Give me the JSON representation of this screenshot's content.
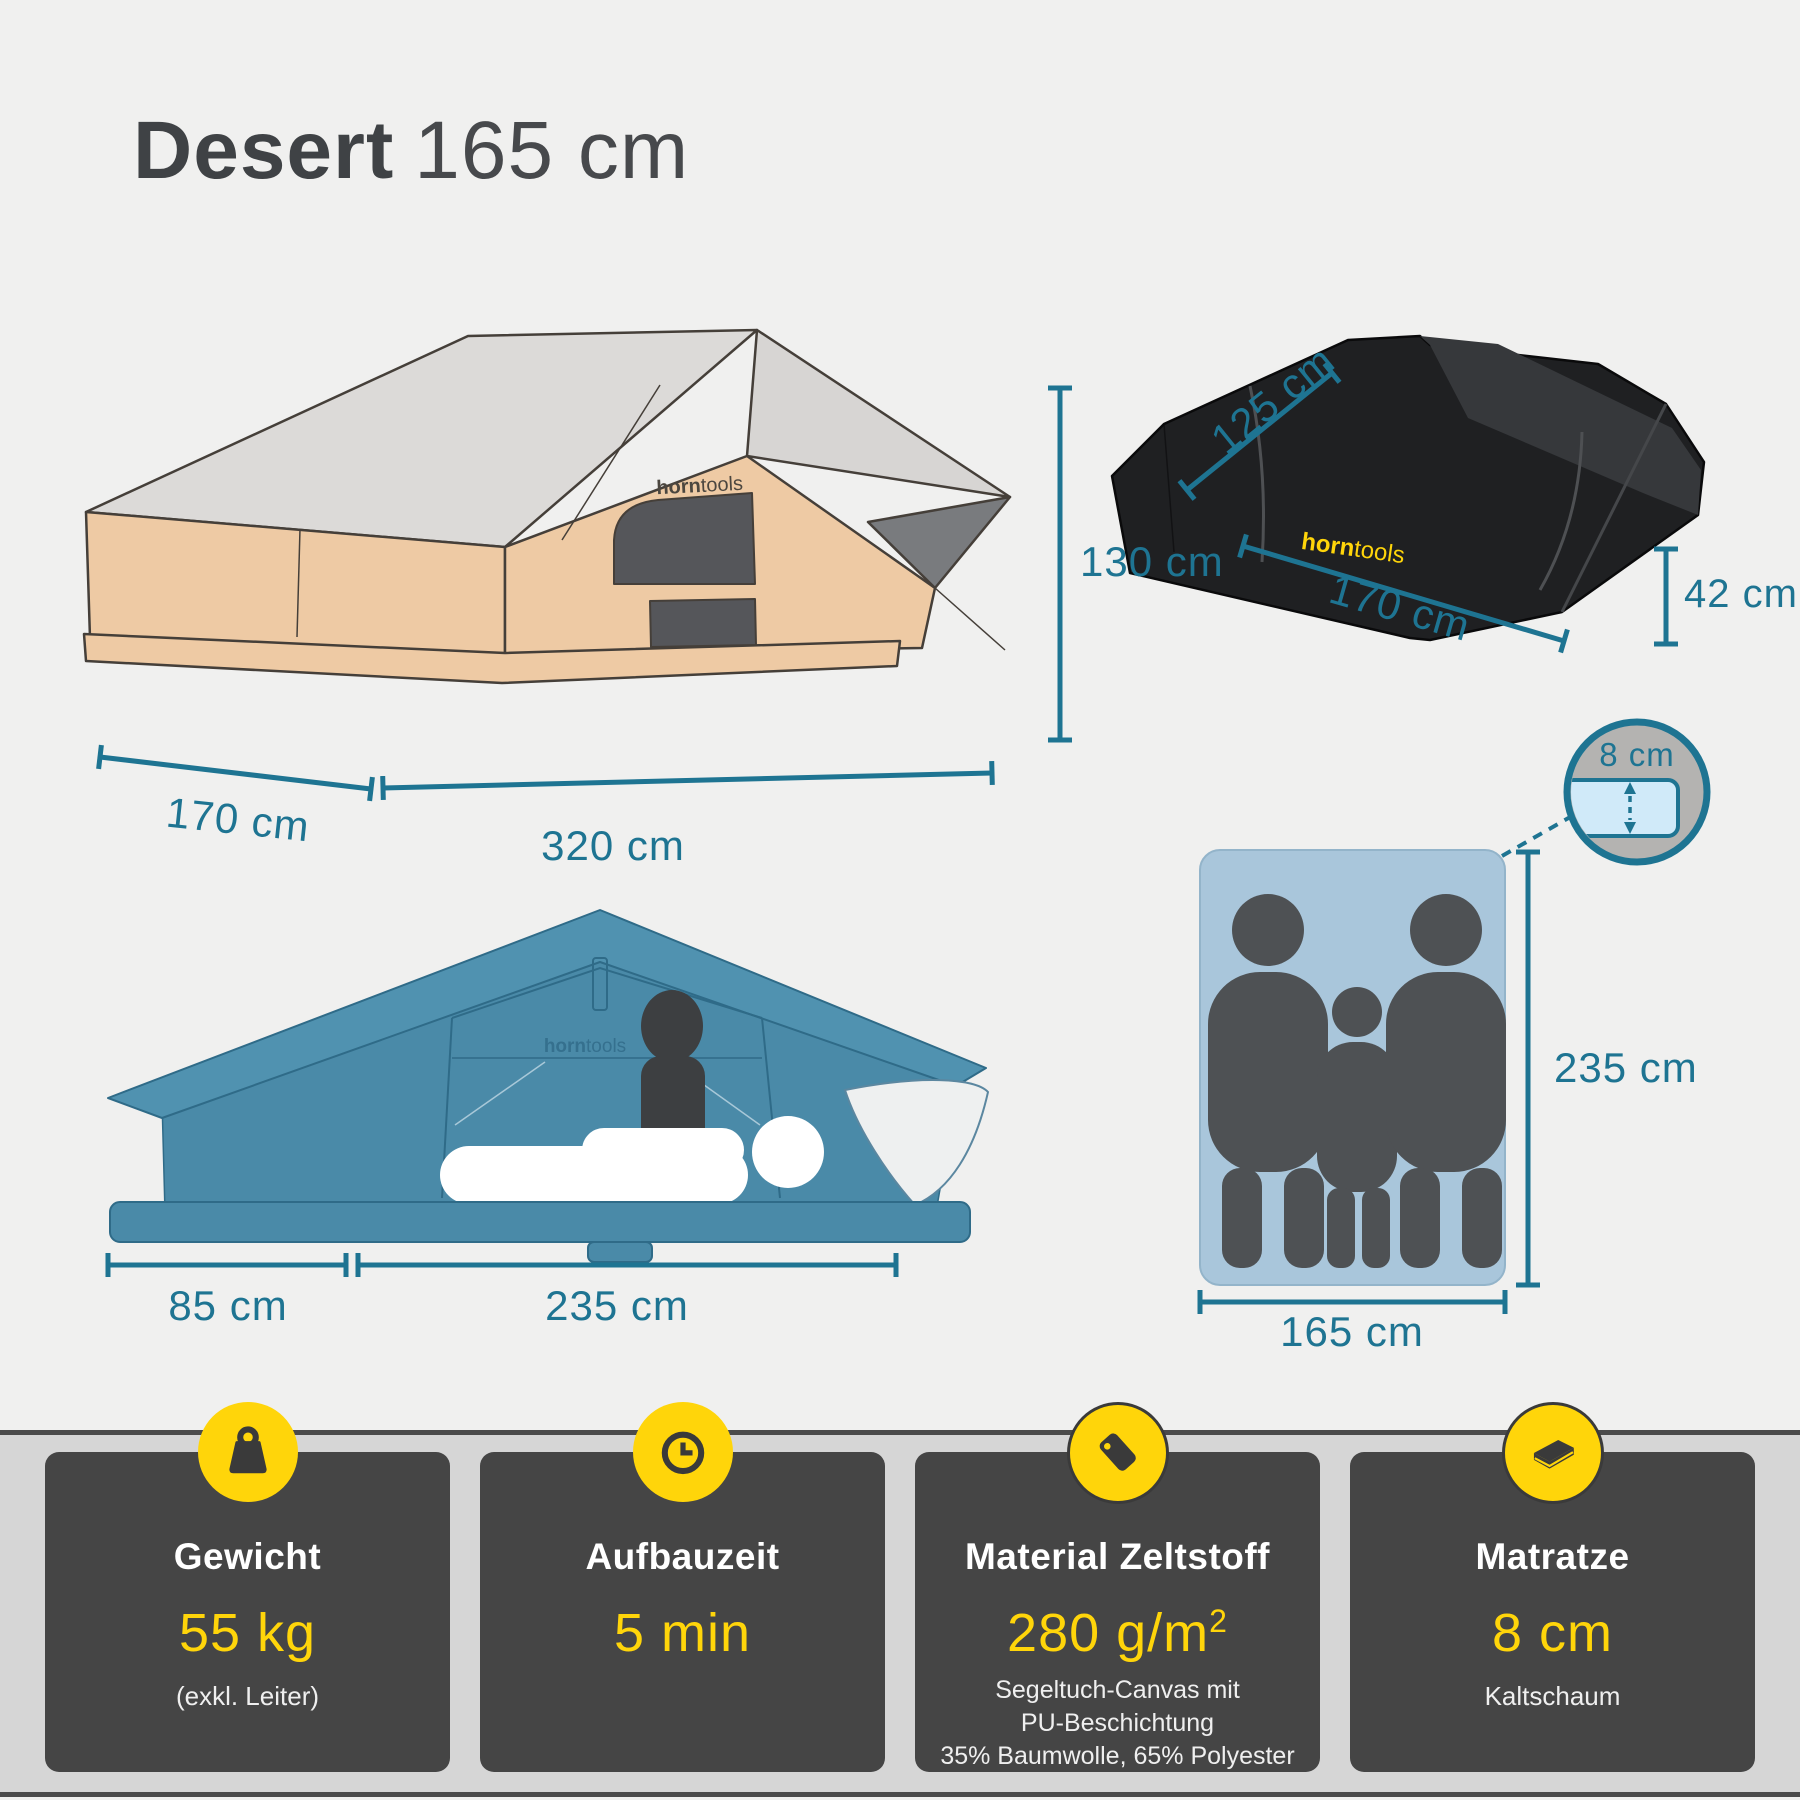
{
  "title": {
    "product": "Desert",
    "size": "165 cm"
  },
  "brand": {
    "bold": "horn",
    "light": "tools"
  },
  "colors": {
    "accent_yellow": "#FFD50A",
    "dimension_teal": "#1E7492",
    "card_bg": "#454545",
    "tent_tan": "#EECAA4",
    "tent_blue": "#4D8CAB",
    "band_gray": "#D6D6D6"
  },
  "dimensions": {
    "side_view": {
      "base_left": "170 cm",
      "base_right": "320 cm",
      "height": "130 cm"
    },
    "packed": {
      "depth": "125 cm",
      "length": "170 cm",
      "height": "42 cm"
    },
    "front_view": {
      "base_left": "85 cm",
      "base_right": "235 cm"
    },
    "mattress": {
      "thickness": "8 cm",
      "length": "235 cm",
      "width": "165 cm"
    }
  },
  "cards": [
    {
      "icon": "weight-icon",
      "title": "Gewicht",
      "value": "55 kg",
      "note_lines": [
        "(exkl. Leiter)"
      ]
    },
    {
      "icon": "clock-icon",
      "title": "Aufbauzeit",
      "value": "5 min",
      "note_lines": []
    },
    {
      "icon": "tag-icon",
      "title": "Material Zeltstoff",
      "value": "280 g/m",
      "value_sup": "2",
      "note_lines": [
        "Segeltuch-Canvas mit",
        "PU-Beschichtung",
        "35% Baumwolle, 65% Polyester"
      ]
    },
    {
      "icon": "mattress-icon",
      "title": "Matratze",
      "value": "8 cm",
      "note_lines": [
        "Kaltschaum"
      ]
    }
  ]
}
